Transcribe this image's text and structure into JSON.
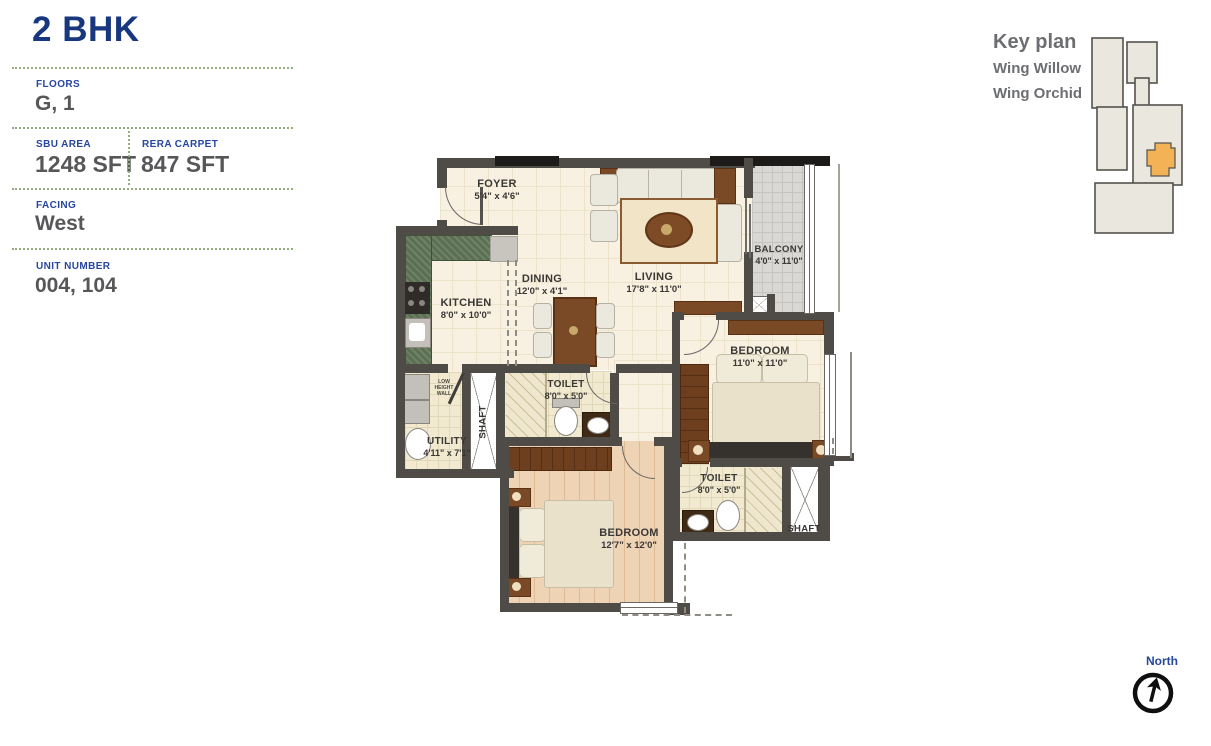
{
  "info_panel": {
    "title": "2 BHK",
    "floors": {
      "label": "FLOORS",
      "value": "G, 1"
    },
    "sbu_area": {
      "label": "SBU AREA",
      "value": "1248 SFT"
    },
    "rera_carpet": {
      "label": "RERA CARPET",
      "value": "847 SFT"
    },
    "facing": {
      "label": "FACING",
      "value": "West"
    },
    "unit_number": {
      "label": "UNIT NUMBER",
      "value": "004, 104"
    }
  },
  "key_plan": {
    "title": "Key plan",
    "wings": [
      "Wing Willow",
      "Wing Orchid"
    ],
    "highlight_color": "#f2b255"
  },
  "compass": {
    "label": "North"
  },
  "floor_plan": {
    "rooms": [
      {
        "name": "FOYER",
        "dims": "5'4\" x 4'6\""
      },
      {
        "name": "LIVING",
        "dims": "17'8\" x 11'0\""
      },
      {
        "name": "BALCONY",
        "dims": "4'0\" x 11'0\""
      },
      {
        "name": "KITCHEN",
        "dims": "8'0\" x 10'0\""
      },
      {
        "name": "DINING",
        "dims": "12'0\" x 4'1\""
      },
      {
        "name": "TOILET",
        "dims": "8'0\" x 5'0\""
      },
      {
        "name": "BEDROOM",
        "dims": "11'0\" x 11'0\""
      },
      {
        "name": "UTILITY",
        "dims": "4'11\" x 7'1\""
      },
      {
        "name": "SHAFT",
        "dims": ""
      },
      {
        "name": "BEDROOM",
        "dims": "12'7\" x 12'0\""
      },
      {
        "name": "TOILET",
        "dims": "8'0\" x 5'0\""
      },
      {
        "name": "SHAFT",
        "dims": ""
      }
    ],
    "annotations": [
      {
        "text": "LOW HEIGHT WALL"
      }
    ]
  },
  "colors": {
    "title_blue": "#17377e",
    "label_blue": "#27479e",
    "value_gray": "#57575a",
    "separator_green": "#96ad7e",
    "wall_gray": "#4f4b47",
    "keyplan_highlight": "#f2b255"
  }
}
